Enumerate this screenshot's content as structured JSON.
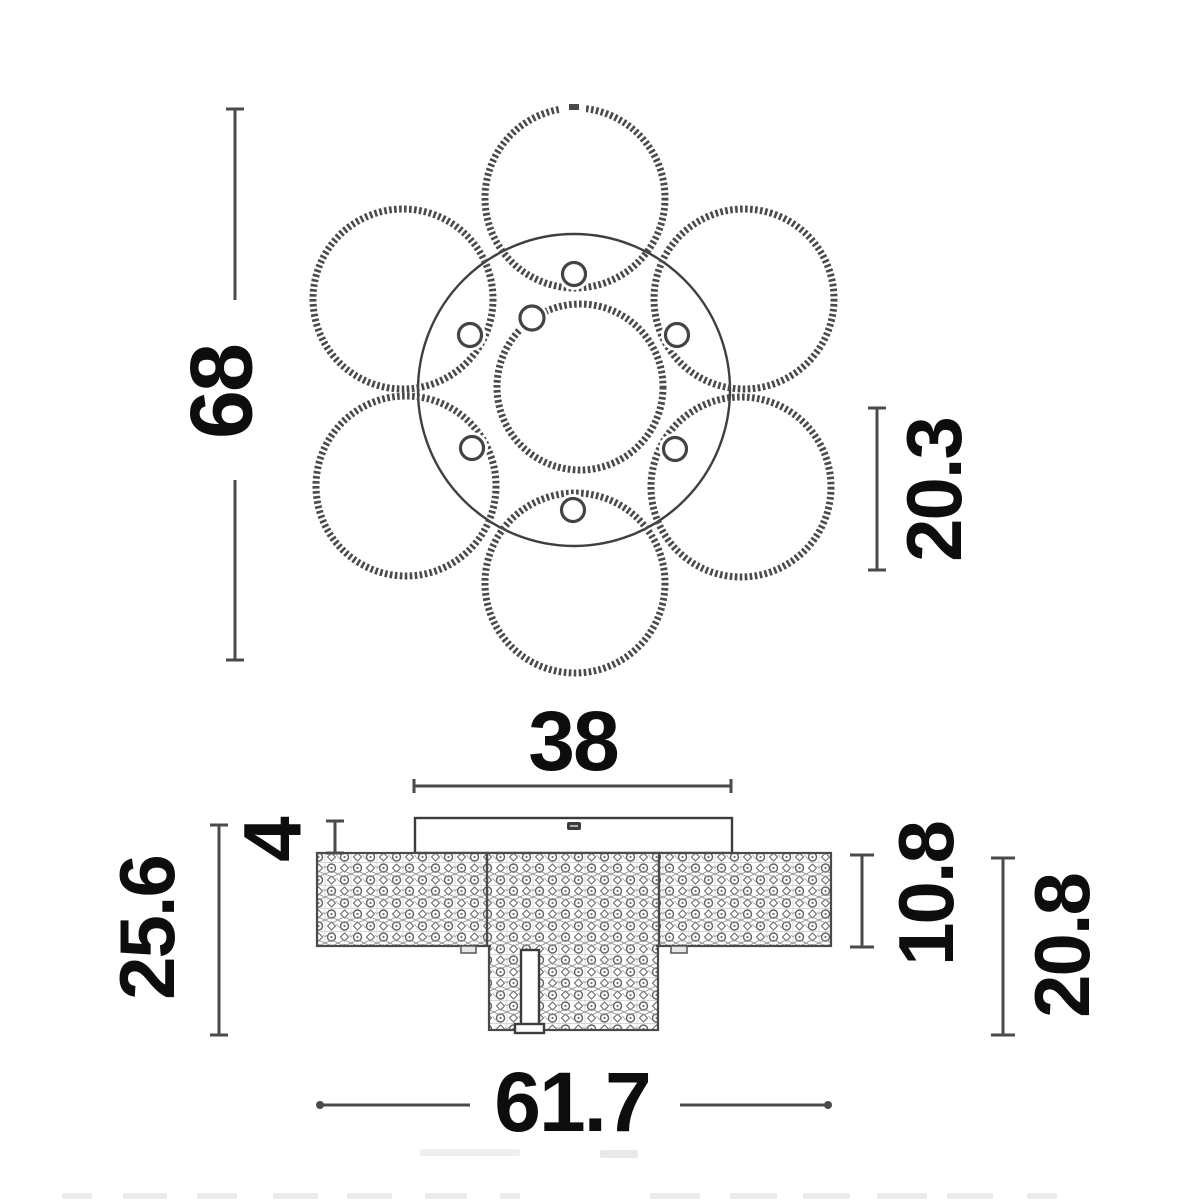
{
  "drawing": {
    "kind": "technical-dimension-diagram",
    "subject": "ring chandelier ceiling light, top view and side view",
    "background": "#ffffff",
    "line_color": "#4a4a4a",
    "text_color": "#0d0d0d"
  },
  "top_view": {
    "rings_textured": 7,
    "connector_beads": 7,
    "dim_overall_height": "68",
    "dim_ring_offset": "20.3"
  },
  "side_view": {
    "dim_canopy_width": "38",
    "dim_canopy_height": "4",
    "dim_overall_height": "25.6",
    "dim_band_height": "10.8",
    "dim_body_height": "20.8",
    "dim_overall_width": "61.7"
  },
  "thumbnail_strip": {
    "fragment_count": 13
  }
}
